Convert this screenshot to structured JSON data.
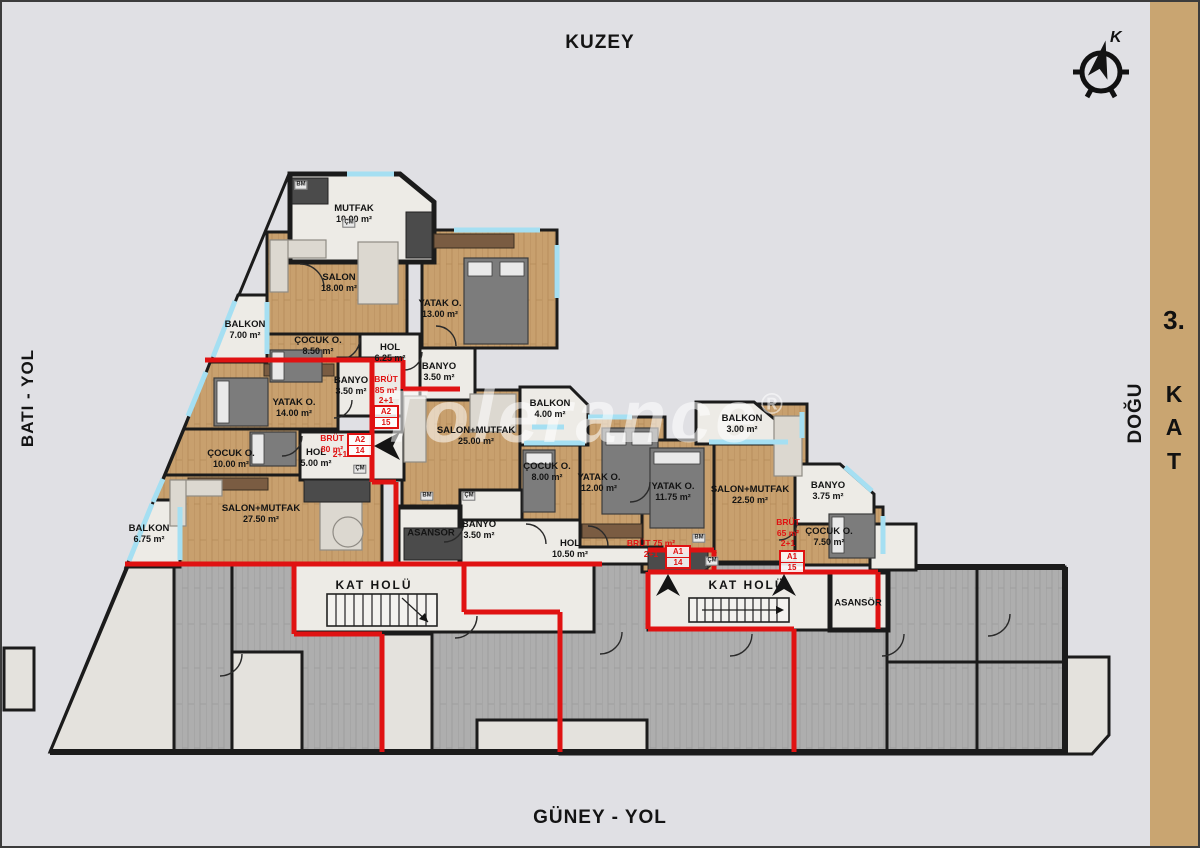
{
  "titles": {
    "top": "KUZEY",
    "bottom": "GÜNEY - YOL",
    "left": "BATI - YOL",
    "right": "DOĞU",
    "floor_num": "3.",
    "floor_letters": [
      "K",
      "A",
      "T"
    ]
  },
  "compass": {
    "label": "K"
  },
  "watermark": {
    "text": "Tolerance",
    "symbol": "®"
  },
  "colors": {
    "red": "#e01212",
    "wood": "#c8a06e",
    "wood_line": "#b58a58",
    "marble": "#edebe6",
    "marble_low": "#e4e2dd",
    "gray_wood": "#aeaeae",
    "gray_wood_line": "#9a9a9a",
    "wall": "#1b1b1b",
    "window": "#a5dff2",
    "bg": "#e0e0e4",
    "band": "#c9a571",
    "watermark": "rgba(255,255,255,0.55)"
  },
  "rooms": [
    {
      "name": "MUTFAK",
      "area": "10.00 m²",
      "x": 352,
      "y": 212
    },
    {
      "name": "SALON",
      "area": "18.00 m²",
      "x": 337,
      "y": 281
    },
    {
      "name": "YATAK O.",
      "area": "13.00 m²",
      "x": 438,
      "y": 307
    },
    {
      "name": "ÇOCUK O.",
      "area": "8.50 m²",
      "x": 316,
      "y": 344
    },
    {
      "name": "HOL",
      "area": "6.25 m²",
      "x": 388,
      "y": 351
    },
    {
      "name": "BANYO",
      "area": "3.50 m²",
      "x": 437,
      "y": 370
    },
    {
      "name": "BALKON",
      "area": "7.00 m²",
      "x": 243,
      "y": 328
    },
    {
      "name": "YATAK O.",
      "area": "14.00 m²",
      "x": 292,
      "y": 406
    },
    {
      "name": "BANYO",
      "area": "3.50 m²",
      "x": 349,
      "y": 384
    },
    {
      "name": "ÇOCUK O.",
      "area": "10.00 m²",
      "x": 229,
      "y": 457
    },
    {
      "name": "HOL",
      "area": "5.00 m²",
      "x": 314,
      "y": 456
    },
    {
      "name": "SALON+MUTFAK",
      "area": "27.50 m²",
      "x": 259,
      "y": 512
    },
    {
      "name": "BALKON",
      "area": "6.75 m²",
      "x": 147,
      "y": 532
    },
    {
      "name": "SALON+MUTFAK",
      "area": "25.00 m²",
      "x": 474,
      "y": 434
    },
    {
      "name": "BALKON",
      "area": "4.00 m²",
      "x": 548,
      "y": 407
    },
    {
      "name": "ÇOCUK O.",
      "area": "8.00 m²",
      "x": 545,
      "y": 470
    },
    {
      "name": "YATAK O.",
      "area": "12.00 m²",
      "x": 597,
      "y": 481
    },
    {
      "name": "BANYO",
      "area": "3.50 m²",
      "x": 477,
      "y": 528
    },
    {
      "name": "HOL",
      "area": "10.50 m²",
      "x": 568,
      "y": 547
    },
    {
      "name": "YATAK O.",
      "area": "11.75 m²",
      "x": 671,
      "y": 490
    },
    {
      "name": "SALON+MUTFAK",
      "area": "22.50 m²",
      "x": 748,
      "y": 493
    },
    {
      "name": "BALKON",
      "area": "3.00 m²",
      "x": 740,
      "y": 422
    },
    {
      "name": "BANYO",
      "area": "3.75 m²",
      "x": 826,
      "y": 489
    },
    {
      "name": "ÇOCUK O.",
      "area": "7.50 m²",
      "x": 827,
      "y": 535
    },
    {
      "name": "ASANSÖR",
      "area": "",
      "x": 429,
      "y": 531
    },
    {
      "name": "ASANSÖR",
      "area": "",
      "x": 856,
      "y": 601
    },
    {
      "name": "KAT HOLÜ",
      "area": "",
      "x": 372,
      "y": 583,
      "common": true
    },
    {
      "name": "KAT HOLÜ",
      "area": "",
      "x": 745,
      "y": 583,
      "common": true
    }
  ],
  "units": [
    {
      "lines": [
        "BRÜT",
        "85 m²",
        "2+1"
      ],
      "tx": 384,
      "ty": 372,
      "code": [
        "A2",
        "15"
      ],
      "bx": 371,
      "by": 403
    },
    {
      "lines": [
        "BRÜT",
        "80 m²"
      ],
      "tx": 330,
      "ty": 431,
      "code": [
        "A2",
        "14"
      ],
      "bx": 345,
      "by": 431,
      "inline": {
        "text": "2+1",
        "x": 338,
        "y": 452
      }
    },
    {
      "lines": [
        "BRÜT 75 m²",
        "2+1"
      ],
      "tx": 649,
      "ty": 536,
      "code": [
        "A1",
        "14"
      ],
      "bx": 663,
      "by": 543
    },
    {
      "lines": [
        "BRÜT",
        "65 m²",
        "2+1"
      ],
      "tx": 786,
      "ty": 515,
      "code": [
        "A1",
        "15"
      ],
      "bx": 777,
      "by": 548
    }
  ],
  "appliance_tags": [
    {
      "t": "BM",
      "x": 299,
      "y": 183
    },
    {
      "t": "ÇM",
      "x": 347,
      "y": 221
    },
    {
      "t": "ÇM",
      "x": 358,
      "y": 467
    },
    {
      "t": "BM",
      "x": 425,
      "y": 494
    },
    {
      "t": "ÇM",
      "x": 467,
      "y": 494
    },
    {
      "t": "BM",
      "x": 697,
      "y": 536
    },
    {
      "t": "ÇM",
      "x": 710,
      "y": 559
    }
  ]
}
